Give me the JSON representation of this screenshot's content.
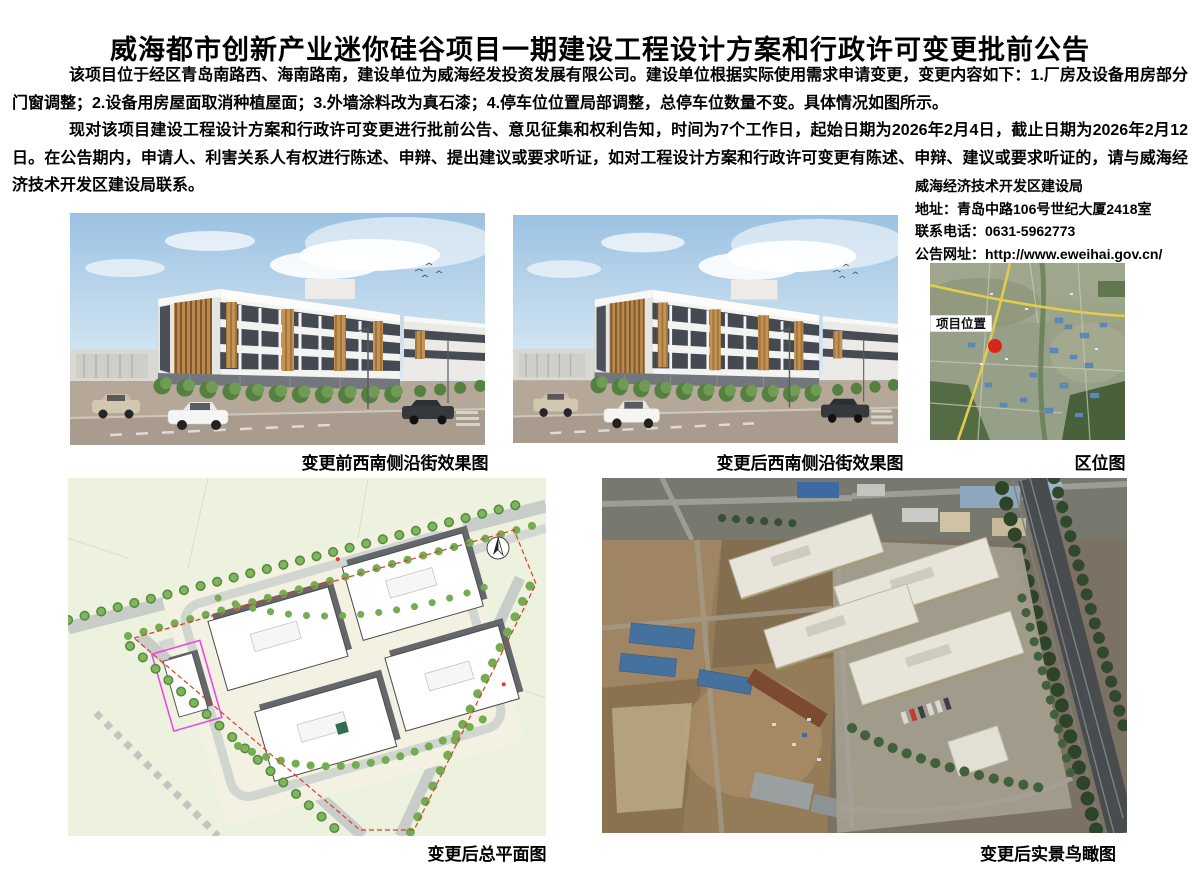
{
  "notice": {
    "title": "威海都市创新产业迷你硅谷项目一期建设工程设计方案和行政许可变更批前公告",
    "paragraph1": "该项目位于经区青岛南路西、海南路南，建设单位为威海经发投资发展有限公司。建设单位根据实际使用需求申请变更，变更内容如下：1.厂房及设备用房部分门窗调整；2.设备用房屋面取消种植屋面；3.外墙涂料改为真石漆；4.停车位位置局部调整，总停车位数量不变。具体情况如图所示。",
    "paragraph2": "现对该项目建设工程设计方案和行政许可变更进行批前公告、意见征集和权利告知，时间为7个工作日，起始日期为2026年2月4日，截止日期为2026年2月12日。在公告期内，申请人、利害关系人有权进行陈述、申辩、提出建议或要求听证，如对工程设计方案和行政许可变更有陈述、申辩、建议或要求听证的，请与威海经济技术开发区建设局联系。"
  },
  "contact": {
    "org": "威海经济技术开发区建设局",
    "address": "地址：青岛中路106号世纪大厦2418室",
    "phone": "联系电话：0631-5962773",
    "website": "公告网址：http://www.eweihai.gov.cn/"
  },
  "figures": {
    "before_render_caption": "变更前西南侧沿街效果图",
    "after_render_caption": "变更后西南侧沿街效果图",
    "location_map_caption": "区位图",
    "site_plan_caption": "变更后总平面图",
    "aerial_caption": "变更后实景鸟瞰图",
    "map_label": "项目位置"
  },
  "colors": {
    "text": "#000000",
    "marker_red": "#d7271d",
    "boundary_magenta": "#e849e8",
    "plan_background_green": "#edf2df",
    "sky_blue": "#9cc2e2",
    "wood_accent": "#c29050",
    "road_yellow": "#e3cc4b"
  }
}
